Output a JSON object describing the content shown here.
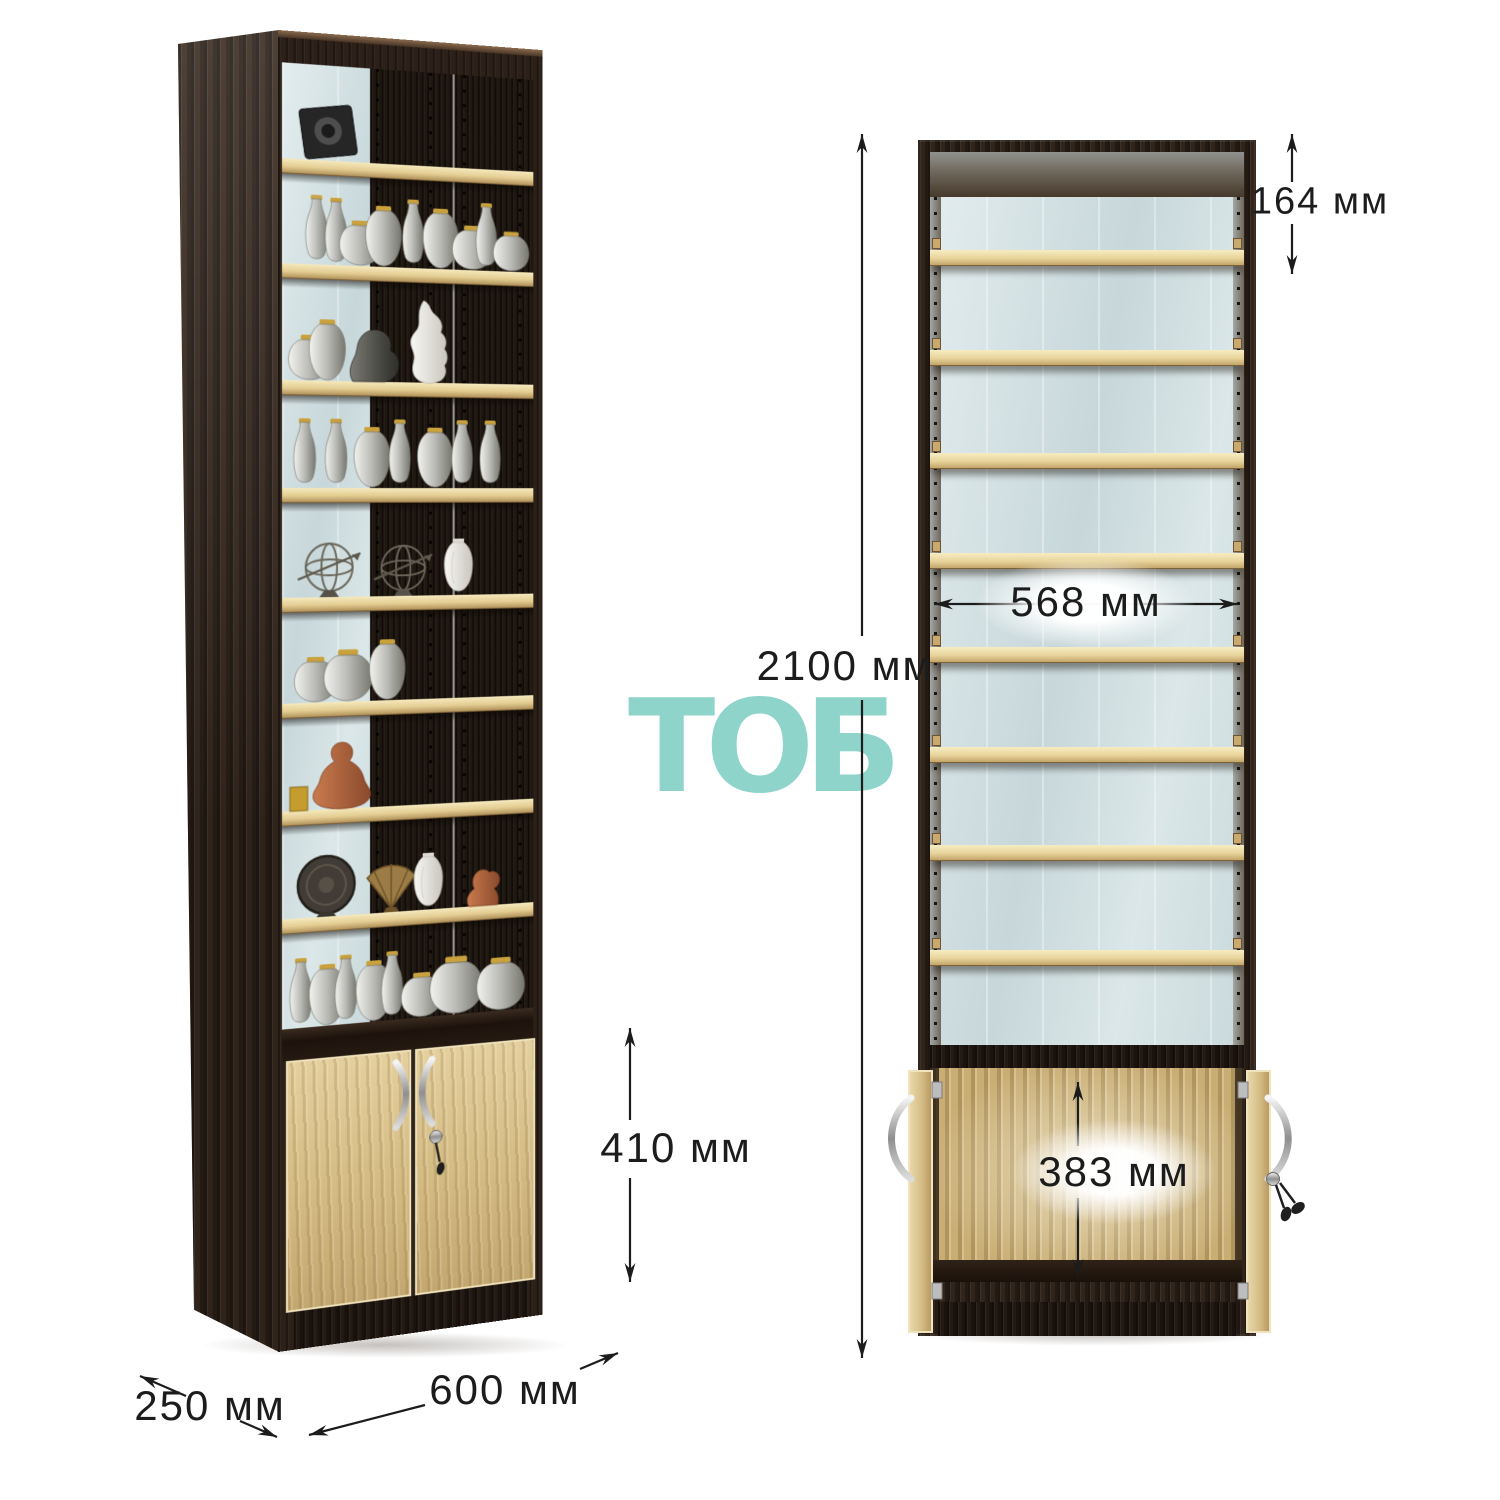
{
  "watermark": {
    "text": "ТОБ",
    "color": "#8ed4ca"
  },
  "dimensions": {
    "overall_height": "2100 мм",
    "top_compartment_height": "164 мм",
    "inner_width": "568 мм",
    "lower_compartment_inner_height": "383 мм",
    "lower_cabinet_height": "410 мм",
    "overall_width": "600 мм",
    "depth": "250 мм"
  },
  "views": {
    "left": {
      "shelf_count": 8,
      "lower_doors": 2
    },
    "right": {
      "shelf_count": 8,
      "lower_doors_open": 2
    }
  },
  "decor_items": [
    "photo-frame",
    "glass-decanters",
    "pewter-pots",
    "silver-jugs",
    "silver-vases",
    "stone-bust",
    "white-ornate-sculpture",
    "slim-silver-decanters",
    "wire-spheres-with-arrows",
    "white-vase",
    "buddha-statue",
    "dark-plate",
    "gold-fan",
    "kneeling-figurine",
    "silver-pot-collection"
  ],
  "colors": {
    "wenge_body": "#31241b",
    "oak_shelf": "#e8d49c",
    "door_oak": "#d7c08b",
    "mirror_back": "#cfdde1",
    "dimension_text": "#1c1c1c",
    "watermark": "#8ed4ca"
  }
}
